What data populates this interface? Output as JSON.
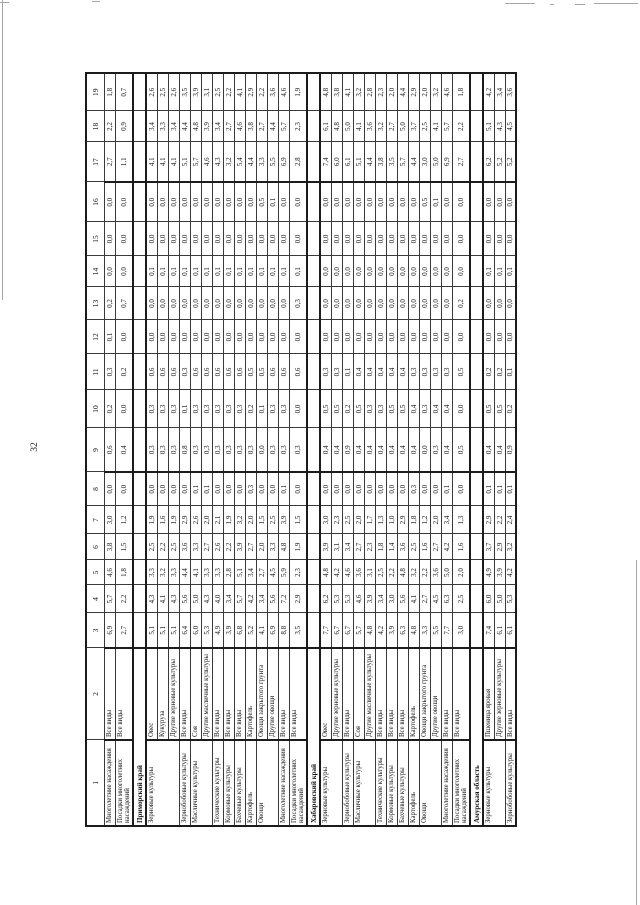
{
  "page": {
    "number": "32"
  },
  "table": {
    "col_headers": [
      "1",
      "2",
      "3",
      "4",
      "5",
      "6",
      "7",
      "8",
      "9",
      "10",
      "11",
      "12",
      "13",
      "14",
      "15",
      "16",
      "17",
      "18",
      "19"
    ],
    "rows": [
      {
        "c1": "Многолетние насаждения",
        "c2": "Все виды",
        "v": [
          "6,9",
          "5,7",
          "4,6",
          "3,8",
          "3,0",
          "0,0",
          "0,6",
          "0,2",
          "0,3",
          "0,1",
          "0,2",
          "0,0",
          "0,0",
          "0,0",
          "2,7",
          "2,2",
          "1,8"
        ]
      },
      {
        "c1": "Посадки многолетних насаждений",
        "c2": "Все виды",
        "v": [
          "2,7",
          "2,2",
          "1,8",
          "1,5",
          "1,2",
          "0,0",
          "0,4",
          "0,0",
          "0,2",
          "0,0",
          "0,7",
          "0,0",
          "0,0",
          "0,0",
          "1,1",
          "0,9",
          "0,7"
        ]
      },
      {
        "section": "Приморский край"
      },
      {
        "c1": "Зерновые культуры",
        "c2": "Овес",
        "v": [
          "5,1",
          "4,3",
          "3,3",
          "2,5",
          "1,9",
          "0,0",
          "0,3",
          "0,3",
          "0,6",
          "0,0",
          "0,0",
          "0,1",
          "0,0",
          "0,0",
          "4,1",
          "3,4",
          "2,6"
        ]
      },
      {
        "c1": "",
        "c2": "Кукуруза",
        "v": [
          "5,1",
          "4,1",
          "3,2",
          "2,2",
          "1,6",
          "0,0",
          "0,3",
          "0,3",
          "0,6",
          "0,0",
          "0,0",
          "0,1",
          "0,0",
          "0,0",
          "4,1",
          "3,3",
          "2,5"
        ]
      },
      {
        "c1": "",
        "c2": "Другие зерновые культуры",
        "v": [
          "5,1",
          "4,3",
          "3,3",
          "2,5",
          "1,9",
          "0,0",
          "0,3",
          "0,3",
          "0,6",
          "0,0",
          "0,0",
          "0,1",
          "0,0",
          "0,0",
          "4,1",
          "3,4",
          "2,6"
        ]
      },
      {
        "c1": "Зернобобовые культуры",
        "c2": "Все виды",
        "v": [
          "6,4",
          "5,6",
          "4,4",
          "3,6",
          "2,9",
          "0,0",
          "0,8",
          "0,1",
          "0,3",
          "0,0",
          "0,0",
          "0,1",
          "0,0",
          "0,0",
          "5,1",
          "4,4",
          "3,5"
        ]
      },
      {
        "c1": "Масличные культуры",
        "c2": "Соя",
        "v": [
          "6,0",
          "5,0",
          "4,1",
          "3,3",
          "2,6",
          "0,1",
          "0,3",
          "0,3",
          "0,6",
          "0,0",
          "0,0",
          "0,1",
          "0,0",
          "0,0",
          "5,7",
          "4,8",
          "3,9"
        ]
      },
      {
        "c1": "",
        "c2": "Другие масличные культуры",
        "v": [
          "5,3",
          "4,3",
          "3,3",
          "2,7",
          "2,0",
          "0,1",
          "0,3",
          "0,3",
          "0,6",
          "0,0",
          "0,0",
          "0,1",
          "0,0",
          "0,0",
          "4,6",
          "3,9",
          "3,1"
        ]
      },
      {
        "c1": "Технические культуры",
        "c2": "Все виды",
        "v": [
          "4,9",
          "4,0",
          "3,3",
          "2,6",
          "2,1",
          "0,0",
          "0,3",
          "0,3",
          "0,6",
          "0,0",
          "0,0",
          "0,1",
          "0,0",
          "0,0",
          "4,3",
          "3,4",
          "2,5"
        ]
      },
      {
        "c1": "Кормовые культуры",
        "c2": "Все виды",
        "v": [
          "3,9",
          "3,4",
          "2,8",
          "2,2",
          "1,9",
          "0,0",
          "0,3",
          "0,3",
          "0,6",
          "0,0",
          "0,0",
          "0,1",
          "0,0",
          "0,0",
          "3,2",
          "2,7",
          "2,2"
        ]
      },
      {
        "c1": "Бахчевые культуры",
        "c2": "Все виды",
        "v": [
          "6,8",
          "5,7",
          "5,1",
          "3,9",
          "3,2",
          "0,0",
          "0,3",
          "0,3",
          "0,6",
          "0,0",
          "0,0",
          "0,1",
          "0,0",
          "0,0",
          "5,4",
          "4,6",
          "4,1"
        ]
      },
      {
        "c1": "Картофель",
        "c2": "Картофель",
        "v": [
          "5,2",
          "4,2",
          "3,4",
          "2,7",
          "2,0",
          "0,3",
          "0,3",
          "0,2",
          "0,5",
          "0,0",
          "0,0",
          "0,1",
          "0,0",
          "0,0",
          "4,4",
          "3,8",
          "2,9"
        ]
      },
      {
        "c1": "Овощи",
        "c2": "Овощи закрытого грунта",
        "v": [
          "4,1",
          "3,4",
          "2,7",
          "2,0",
          "1,5",
          "0,0",
          "0,0",
          "0,1",
          "0,5",
          "0,0",
          "0,0",
          "0,1",
          "0,0",
          "0,5",
          "3,3",
          "2,7",
          "2,2"
        ]
      },
      {
        "c1": "",
        "c2": "Другие овощи",
        "v": [
          "6,9",
          "5,6",
          "4,5",
          "3,3",
          "2,5",
          "0,0",
          "0,3",
          "0,3",
          "0,6",
          "0,0",
          "0,0",
          "0,1",
          "0,0",
          "0,1",
          "5,5",
          "4,4",
          "3,6"
        ]
      },
      {
        "c1": "Многолетние насаждения",
        "c2": "Все виды",
        "v": [
          "8,8",
          "7,2",
          "5,9",
          "4,8",
          "3,9",
          "0,1",
          "0,3",
          "0,3",
          "0,6",
          "0,0",
          "0,0",
          "0,1",
          "0,0",
          "0,0",
          "6,9",
          "5,7",
          "4,6"
        ]
      },
      {
        "c1": "Посадки многолетних насаждений",
        "c2": "Все виды",
        "v": [
          "3,5",
          "2,9",
          "2,3",
          "1,9",
          "1,5",
          "0,0",
          "0,3",
          "0,0",
          "0,6",
          "0,0",
          "0,3",
          "0,1",
          "0,0",
          "0,0",
          "2,8",
          "2,3",
          "1,9"
        ]
      },
      {
        "section": "Хабаровский край"
      },
      {
        "c1": "Зерновые культуры",
        "c2": "Овес",
        "v": [
          "7,7",
          "6,2",
          "4,8",
          "3,9",
          "3,0",
          "0,0",
          "0,4",
          "0,5",
          "0,3",
          "0,0",
          "0,0",
          "0,0",
          "0,0",
          "0,0",
          "7,4",
          "6,1",
          "4,8"
        ]
      },
      {
        "c1": "",
        "c2": "Другие зерновые культуры",
        "v": [
          "6,7",
          "5,3",
          "4,2",
          "3,1",
          "2,3",
          "0,0",
          "0,4",
          "0,5",
          "0,3",
          "0,0",
          "0,0",
          "0,0",
          "0,0",
          "0,0",
          "6,0",
          "4,8",
          "3,8"
        ]
      },
      {
        "c1": "Зернобобовые культуры",
        "c2": "Все виды",
        "v": [
          "6,7",
          "5,3",
          "4,6",
          "3,4",
          "2,5",
          "0,0",
          "0,9",
          "0,2",
          "0,1",
          "0,0",
          "0,0",
          "0,0",
          "0,0",
          "0,0",
          "6,1",
          "5,0",
          "4,1"
        ]
      },
      {
        "c1": "Масличные культуры",
        "c2": "Соя",
        "v": [
          "5,7",
          "4,6",
          "3,6",
          "2,7",
          "2,0",
          "0,0",
          "0,4",
          "0,5",
          "0,4",
          "0,0",
          "0,0",
          "0,0",
          "0,0",
          "0,0",
          "5,1",
          "4,1",
          "3,2"
        ]
      },
      {
        "c1": "",
        "c2": "Другие масличные культуры",
        "v": [
          "4,8",
          "3,9",
          "3,1",
          "2,3",
          "1,7",
          "0,0",
          "0,4",
          "0,3",
          "0,4",
          "0,0",
          "0,0",
          "0,0",
          "0,0",
          "0,0",
          "4,4",
          "3,6",
          "2,8"
        ]
      },
      {
        "c1": "Технические культуры",
        "c2": "Все виды",
        "v": [
          "4,2",
          "3,4",
          "2,5",
          "1,8",
          "1,3",
          "0,0",
          "0,4",
          "0,3",
          "0,4",
          "0,0",
          "0,0",
          "0,0",
          "0,0",
          "0,0",
          "3,8",
          "3,2",
          "2,3"
        ]
      },
      {
        "c1": "Кормовые культуры",
        "c2": "Все виды",
        "v": [
          "3,9",
          "3,0",
          "2,2",
          "1,4",
          "1,0",
          "0,0",
          "0,4",
          "0,5",
          "0,4",
          "0,0",
          "0,0",
          "0,0",
          "0,0",
          "0,0",
          "3,5",
          "2,7",
          "2,0"
        ]
      },
      {
        "c1": "Бахчевые культуры",
        "c2": "Все виды",
        "v": [
          "6,3",
          "5,6",
          "4,8",
          "3,6",
          "2,9",
          "0,0",
          "0,4",
          "0,5",
          "0,4",
          "0,0",
          "0,0",
          "0,0",
          "0,0",
          "0,0",
          "5,7",
          "5,0",
          "4,4"
        ]
      },
      {
        "c1": "Картофель",
        "c2": "Картофель",
        "v": [
          "4,8",
          "4,1",
          "3,2",
          "2,5",
          "1,8",
          "0,3",
          "0,4",
          "0,4",
          "0,3",
          "0,0",
          "0,0",
          "0,0",
          "0,0",
          "0,0",
          "4,4",
          "3,7",
          "2,9"
        ]
      },
      {
        "c1": "Овощи",
        "c2": "Овощи закрытого грунта",
        "v": [
          "3,3",
          "2,7",
          "2,2",
          "1,6",
          "1,2",
          "0,0",
          "0,0",
          "0,3",
          "0,3",
          "0,0",
          "0,0",
          "0,0",
          "0,0",
          "0,5",
          "3,0",
          "2,5",
          "2,0"
        ]
      },
      {
        "c1": "",
        "c2": "Другие овощи",
        "v": [
          "5,5",
          "4,5",
          "3,6",
          "2,7",
          "2,0",
          "0,0",
          "0,3",
          "0,4",
          "0,3",
          "0,0",
          "0,0",
          "0,0",
          "0,0",
          "0,1",
          "5,0",
          "4,1",
          "3,2"
        ]
      },
      {
        "c1": "Многолетние насаждения",
        "c2": "Все виды",
        "v": [
          "7,7",
          "6,3",
          "5,0",
          "4,2",
          "3,4",
          "0,1",
          "0,4",
          "0,4",
          "0,3",
          "0,0",
          "0,0",
          "0,0",
          "0,0",
          "0,0",
          "6,9",
          "5,7",
          "4,6"
        ]
      },
      {
        "c1": "Посадки многолетних насаждений",
        "c2": "Все виды",
        "v": [
          "3,0",
          "2,5",
          "2,0",
          "1,6",
          "1,3",
          "0,0",
          "0,5",
          "0,0",
          "0,5",
          "0,0",
          "0,2",
          "0,0",
          "0,0",
          "0,0",
          "2,7",
          "2,2",
          "1,8"
        ]
      },
      {
        "section": "Амурская область"
      },
      {
        "c1": "Зерновые культуры",
        "c2": "Пшеница яровая",
        "v": [
          "7,4",
          "6,0",
          "4,9",
          "3,7",
          "2,9",
          "0,1",
          "0,4",
          "0,5",
          "0,2",
          "0,0",
          "0,0",
          "0,1",
          "0,0",
          "0,0",
          "6,2",
          "5,1",
          "4,2"
        ]
      },
      {
        "c1": "",
        "c2": "Другие зерновые культуры",
        "v": [
          "6,1",
          "5,0",
          "3,9",
          "2,9",
          "2,2",
          "0,1",
          "0,4",
          "0,5",
          "0,2",
          "0,0",
          "0,0",
          "0,1",
          "0,0",
          "0,0",
          "5,2",
          "4,3",
          "3,4"
        ]
      },
      {
        "c1": "Зернобобовые культуры",
        "c2": "Все виды",
        "v": [
          "6,1",
          "5,3",
          "4,2",
          "3,2",
          "2,4",
          "0,1",
          "0,9",
          "0,2",
          "0,1",
          "0,0",
          "0,0",
          "0,1",
          "0,0",
          "0,0",
          "5,2",
          "4,5",
          "3,6"
        ]
      }
    ]
  }
}
